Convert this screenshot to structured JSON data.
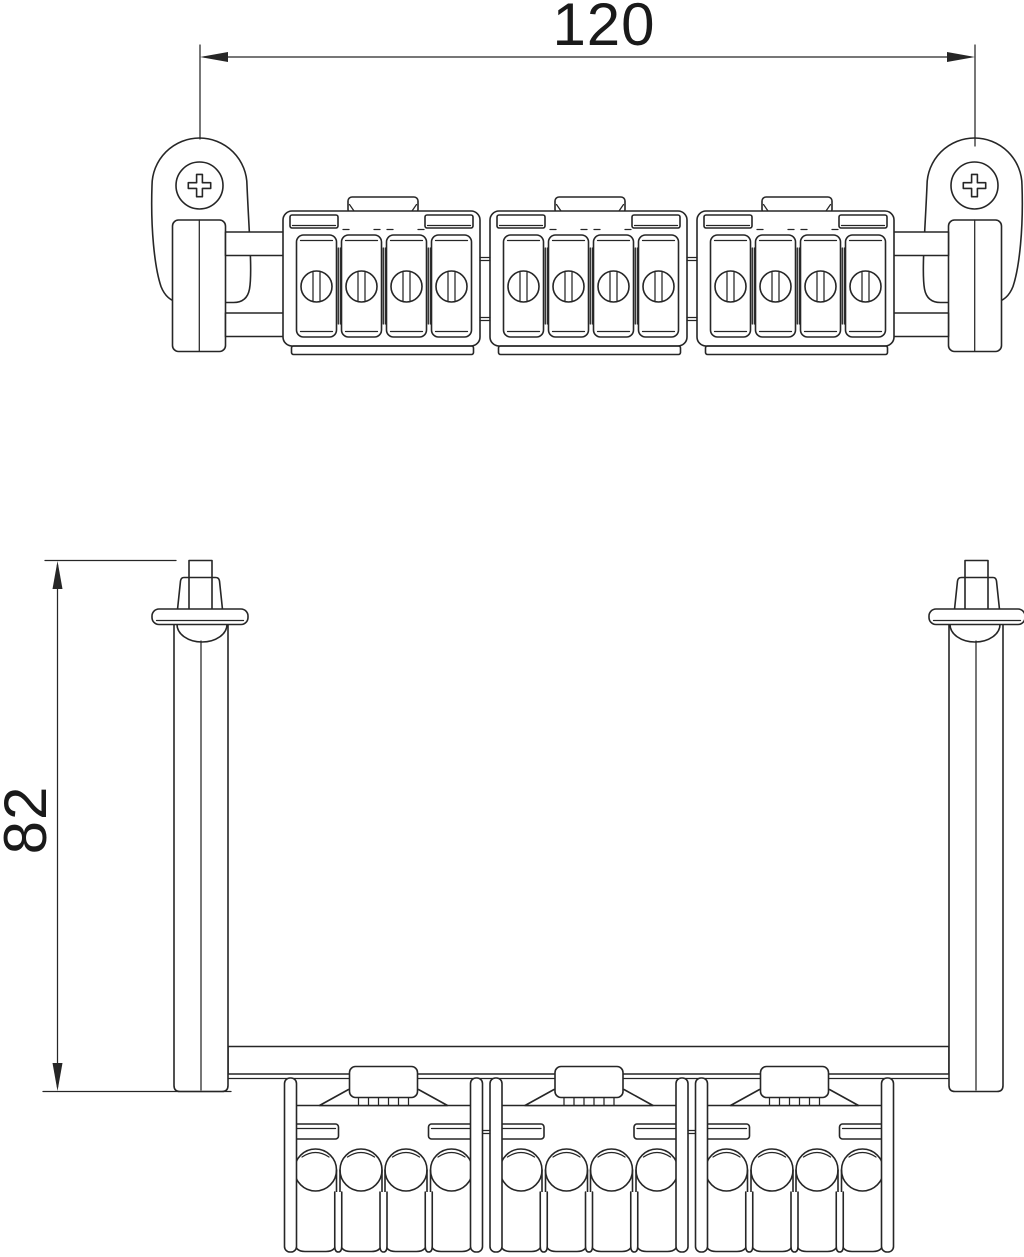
{
  "drawing": {
    "kind": "technical-line-drawing",
    "dimensions": {
      "width": {
        "value": "120",
        "orientation": "horizontal"
      },
      "height": {
        "value": "82",
        "orientation": "vertical"
      }
    },
    "style": {
      "line_color": "#262626",
      "text_color": "#1a1a1a",
      "background": "#ffffff"
    },
    "components": {
      "terminal_blocks": 3,
      "terminals_per_block": 4,
      "mounting_screws": 2
    }
  }
}
